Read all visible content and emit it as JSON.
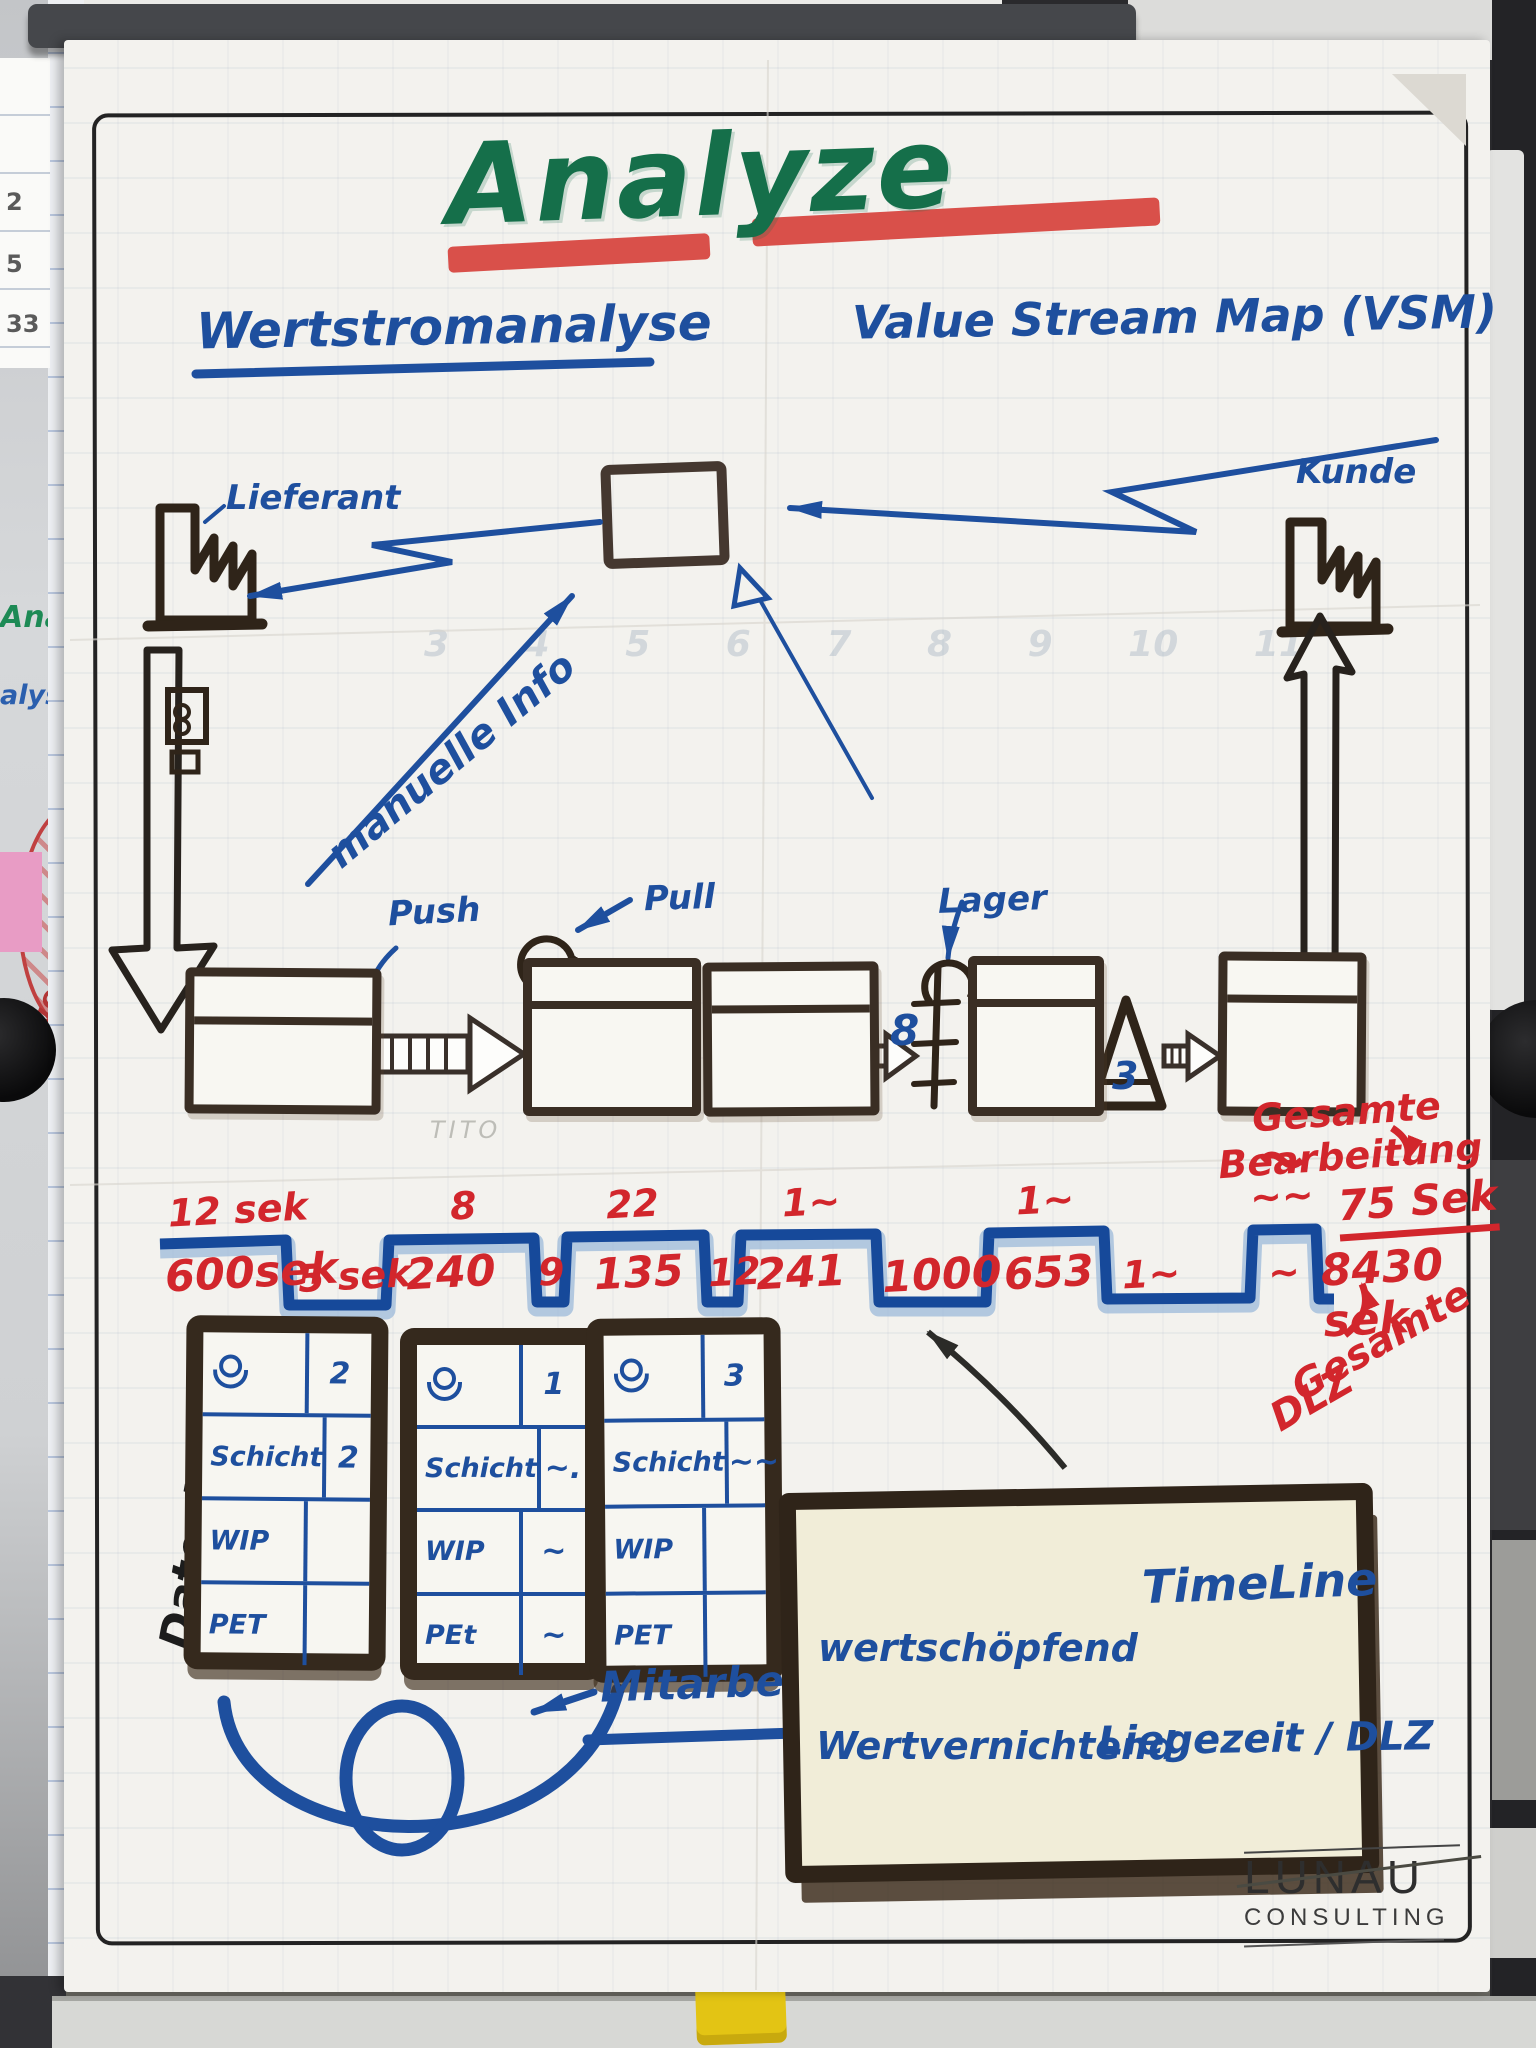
{
  "title": "Analyze",
  "subtitle_left": "Wertstromanalyse",
  "subtitle_right": "Value Stream Map (VSM)",
  "labels": {
    "supplier": "Lieferant",
    "customer": "Kunde",
    "manual_info": "manuelle Info",
    "push": "Push",
    "pull": "Pull",
    "storage": "Lager",
    "inventory_count": "8",
    "triangle_count": "3",
    "datenbox": "Datenbox",
    "mitarbeiter": "Mitarbeiter",
    "pencil_note": "TITO"
  },
  "totals": {
    "processing_line1": "Gesamte",
    "processing_line2": "Bearbeitung",
    "processing_value": "75 Sek",
    "dlz_line1": "Gesamte",
    "dlz_line2": "DLZ",
    "dlz_value": "8430 sek"
  },
  "timeline": {
    "top_values": [
      "12 sek",
      "8",
      "22",
      "1~",
      "1~",
      "~~"
    ],
    "bottom_values": [
      "600sek",
      "5 sek",
      "240",
      "9",
      "135",
      "12",
      "241",
      "1000",
      "653",
      "1~",
      "~"
    ]
  },
  "databoxes": [
    {
      "operators": "2",
      "rows": [
        {
          "label": "Schicht",
          "value": "2"
        },
        {
          "label": "WIP",
          "value": ""
        },
        {
          "label": "PET",
          "value": ""
        }
      ]
    },
    {
      "operators": "1",
      "rows": [
        {
          "label": "Schicht",
          "value": "~."
        },
        {
          "label": "WIP",
          "value": "~"
        },
        {
          "label": "PEt",
          "value": "~"
        }
      ]
    },
    {
      "operators": "3",
      "rows": [
        {
          "label": "Schicht",
          "value": "~~"
        },
        {
          "label": "WIP",
          "value": ""
        },
        {
          "label": "PET",
          "value": ""
        }
      ]
    }
  ],
  "legend": {
    "timeline_label": "TimeLine",
    "value_adding": "wertschöpfend",
    "non_value_adding": "Wertvernichtend",
    "wait_label": "Liegezeit / DLZ"
  },
  "logo": {
    "line1": "LUNAU",
    "line2": "CONSULTING"
  },
  "background": {
    "frag_green": "Anal",
    "frag_blue": "alyse",
    "frag_red": "MWOOD",
    "ruler_numbers": [
      "2",
      "5",
      "33"
    ],
    "ghost_numbers": [
      "3",
      "4",
      "5",
      "6",
      "7",
      "8",
      "9",
      "10",
      "11"
    ]
  }
}
